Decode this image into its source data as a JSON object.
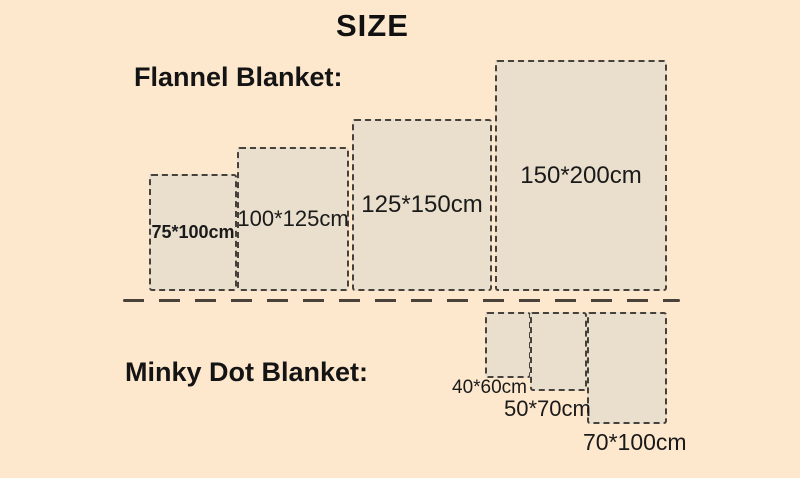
{
  "title": "SIZE",
  "colors": {
    "background": "#fde8cd",
    "rect_fill": "#e9dfcc",
    "rect_border": "#46413b",
    "divider": "#4a413a",
    "text": "#141414"
  },
  "flannel": {
    "label": "Flannel Blanket:",
    "sizes": [
      {
        "label": "75*100cm",
        "width_cm": 75,
        "height_cm": 100
      },
      {
        "label": "100*125cm",
        "width_cm": 100,
        "height_cm": 125
      },
      {
        "label": "125*150cm",
        "width_cm": 125,
        "height_cm": 150
      },
      {
        "label": "150*200cm",
        "width_cm": 150,
        "height_cm": 200
      }
    ]
  },
  "minky": {
    "label": "Minky Dot Blanket:",
    "sizes": [
      {
        "label": "40*60cm",
        "width_cm": 40,
        "height_cm": 60
      },
      {
        "label": "50*70cm",
        "width_cm": 50,
        "height_cm": 70
      },
      {
        "label": "70*100cm",
        "width_cm": 70,
        "height_cm": 100
      }
    ]
  }
}
